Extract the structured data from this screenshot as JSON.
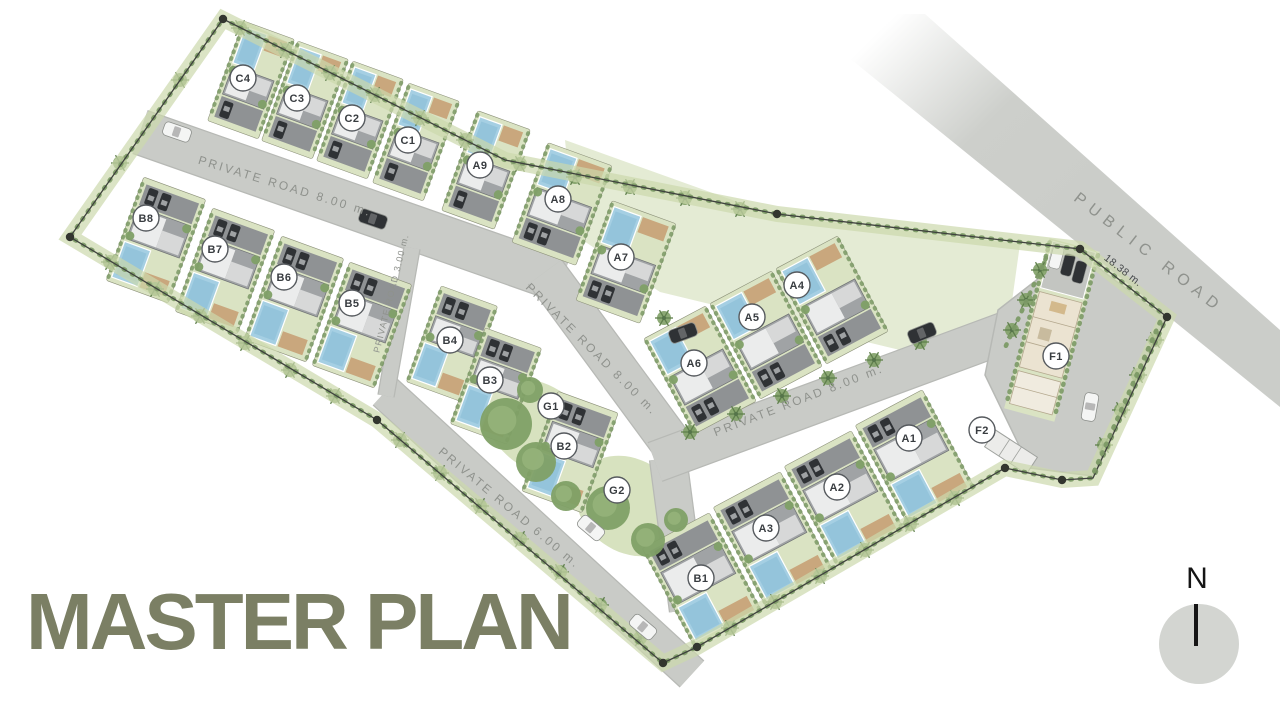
{
  "title": {
    "text": "MASTER PLAN",
    "color": "#7b7f64"
  },
  "compass": {
    "letter": "N",
    "cx": 1199,
    "cy": 644,
    "r": 40
  },
  "palette": {
    "road": "#c9cbc7",
    "road_edge": "#b7b9b5",
    "public_road": "#cdcfcb",
    "lawn": "#dae3c3",
    "lawn_light": "#e4ebd4",
    "hedge": "#7c9a66",
    "hedge_soft": "#ccd9ac",
    "tree": "#7fa066",
    "tree_inner": "#95b27a",
    "pool": "#a5cfe3",
    "pool_dark": "#86bcd6",
    "deck": "#c9a77d",
    "house": "#a0a3a5",
    "roof_white": "#ebecec",
    "roof_gray": "#d7d8d8",
    "driveway": "#8f9294",
    "car_dark": "#2f3235",
    "car_white": "#f4f5f4",
    "boundary": "#3f423e",
    "node": "#33362f",
    "marker_stroke": "#565a5e",
    "marker_text": "#383c40",
    "road_label": "#8f928d",
    "road_label_dark": "#46494b"
  },
  "map": {
    "boundary": {
      "points": [
        [
          223,
          19
        ],
        [
          505,
          160
        ],
        [
          777,
          214
        ],
        [
          1080,
          249
        ],
        [
          1167,
          317
        ],
        [
          1093,
          478
        ],
        [
          1062,
          480
        ],
        [
          1005,
          468
        ],
        [
          697,
          647
        ],
        [
          663,
          663
        ],
        [
          377,
          420
        ],
        [
          70,
          237
        ]
      ],
      "nodes": [
        [
          223,
          19
        ],
        [
          777,
          214
        ],
        [
          1080,
          249
        ],
        [
          1167,
          317
        ],
        [
          1062,
          480
        ],
        [
          1005,
          468
        ],
        [
          697,
          647
        ],
        [
          663,
          663
        ],
        [
          377,
          420
        ],
        [
          70,
          237
        ]
      ]
    },
    "roads": [
      {
        "name": "private-road-8m-north",
        "path": "M140,132 L562,280",
        "width": 44
      },
      {
        "name": "private-road-8m-mid",
        "path": "M545,272 L676,450",
        "width": 40
      },
      {
        "name": "junction-connector",
        "path": "M668,458 L688,610",
        "width": 36
      },
      {
        "name": "private-road-8m-south",
        "path": "M655,462 L1012,330",
        "width": 40
      },
      {
        "name": "private-road-6m",
        "path": "M385,392 L692,674",
        "width": 34
      },
      {
        "name": "private-road-3m",
        "path": "M412,248 L386,396",
        "width": 15
      }
    ],
    "plaza": [
      [
        998,
        310
      ],
      [
        1075,
        250
      ],
      [
        1165,
        318
      ],
      [
        1093,
        476
      ],
      [
        1030,
        468
      ],
      [
        985,
        375
      ]
    ],
    "public_road": {
      "points": [
        [
          795,
          14
        ],
        [
          925,
          14
        ],
        [
          1280,
          330
        ],
        [
          1280,
          407
        ]
      ],
      "fade_from": [
        880,
        30
      ],
      "fade_to": [
        1060,
        215
      ]
    },
    "lawns": [
      {
        "type": "poly",
        "points": [
          [
            565,
            140
          ],
          [
            777,
            216
          ],
          [
            1020,
            244
          ],
          [
            1008,
            330
          ],
          [
            900,
            350
          ],
          [
            660,
            292
          ],
          [
            575,
            235
          ]
        ]
      },
      {
        "type": "ellipse",
        "cx": 540,
        "cy": 428,
        "rx": 62,
        "ry": 42,
        "rot": 35
      },
      {
        "type": "ellipse",
        "cx": 630,
        "cy": 506,
        "rx": 58,
        "ry": 46,
        "rot": 35
      }
    ],
    "entrance_hedges": [
      [
        [
          1046,
          258
        ],
        [
          1004,
          350
        ]
      ],
      [
        [
          1160,
          322
        ],
        [
          1093,
          474
        ]
      ]
    ],
    "villas": [
      {
        "id": "C4",
        "x": 251,
        "y": 80,
        "w": 54,
        "h": 106,
        "rot": 20,
        "flip": false
      },
      {
        "id": "C3",
        "x": 305,
        "y": 100,
        "w": 54,
        "h": 106,
        "rot": 20,
        "flip": false
      },
      {
        "id": "C2",
        "x": 360,
        "y": 120,
        "w": 54,
        "h": 106,
        "rot": 20,
        "flip": false
      },
      {
        "id": "C1",
        "x": 416,
        "y": 142,
        "w": 54,
        "h": 106,
        "rot": 20,
        "flip": false
      },
      {
        "id": "A9",
        "x": 486,
        "y": 170,
        "w": 56,
        "h": 106,
        "rot": 20,
        "flip": false
      },
      {
        "id": "A8",
        "x": 562,
        "y": 204,
        "w": 68,
        "h": 106,
        "rot": 20,
        "flip": false
      },
      {
        "id": "A7",
        "x": 626,
        "y": 262,
        "w": 68,
        "h": 106,
        "rot": 20,
        "flip": false
      },
      {
        "id": "B8",
        "x": 156,
        "y": 240,
        "w": 66,
        "h": 110,
        "rot": 20,
        "flip": true
      },
      {
        "id": "B7",
        "x": 225,
        "y": 271,
        "w": 66,
        "h": 110,
        "rot": 20,
        "flip": true
      },
      {
        "id": "B6",
        "x": 294,
        "y": 299,
        "w": 66,
        "h": 110,
        "rot": 20,
        "flip": true
      },
      {
        "id": "B5",
        "x": 362,
        "y": 325,
        "w": 66,
        "h": 110,
        "rot": 20,
        "flip": true
      },
      {
        "id": "B4",
        "x": 452,
        "y": 344,
        "w": 60,
        "h": 102,
        "rot": 20,
        "flip": true
      },
      {
        "id": "B3",
        "x": 496,
        "y": 386,
        "w": 60,
        "h": 102,
        "rot": 20,
        "flip": true
      },
      {
        "id": "B2",
        "x": 570,
        "y": 452,
        "w": 64,
        "h": 106,
        "rot": 20,
        "flip": true
      },
      {
        "id": "A6",
        "x": 700,
        "y": 370,
        "w": 70,
        "h": 108,
        "rot": -28,
        "flip": false
      },
      {
        "id": "A5",
        "x": 766,
        "y": 335,
        "w": 70,
        "h": 108,
        "rot": -28,
        "flip": false
      },
      {
        "id": "A4",
        "x": 832,
        "y": 300,
        "w": 70,
        "h": 108,
        "rot": -28,
        "flip": false
      },
      {
        "id": "B1",
        "x": 702,
        "y": 580,
        "w": 76,
        "h": 112,
        "rot": -28,
        "flip": true
      },
      {
        "id": "A3",
        "x": 773,
        "y": 539,
        "w": 76,
        "h": 112,
        "rot": -28,
        "flip": true
      },
      {
        "id": "A2",
        "x": 844,
        "y": 498,
        "w": 76,
        "h": 112,
        "rot": -28,
        "flip": true
      },
      {
        "id": "A1",
        "x": 915,
        "y": 457,
        "w": 76,
        "h": 112,
        "rot": -28,
        "flip": true
      }
    ],
    "facilities": {
      "f1": {
        "x": 1052,
        "y": 330,
        "rot": 15
      },
      "f2": {
        "x": 1011,
        "y": 452,
        "rot": 33
      }
    },
    "plot_markers": [
      {
        "id": "C4",
        "label": "C4",
        "x": 243,
        "y": 78
      },
      {
        "id": "C3",
        "label": "C3",
        "x": 297,
        "y": 98
      },
      {
        "id": "C2",
        "label": "C2",
        "x": 352,
        "y": 118
      },
      {
        "id": "C1",
        "label": "C1",
        "x": 408,
        "y": 140
      },
      {
        "id": "A9",
        "label": "A9",
        "x": 480,
        "y": 165
      },
      {
        "id": "A8",
        "label": "A8",
        "x": 558,
        "y": 199
      },
      {
        "id": "A7",
        "label": "A7",
        "x": 621,
        "y": 257
      },
      {
        "id": "B8",
        "label": "B8",
        "x": 146,
        "y": 218
      },
      {
        "id": "B7",
        "label": "B7",
        "x": 215,
        "y": 249
      },
      {
        "id": "B6",
        "label": "B6",
        "x": 284,
        "y": 277
      },
      {
        "id": "B5",
        "label": "B5",
        "x": 352,
        "y": 303
      },
      {
        "id": "B4",
        "label": "B4",
        "x": 450,
        "y": 340
      },
      {
        "id": "B3",
        "label": "B3",
        "x": 490,
        "y": 380
      },
      {
        "id": "G1",
        "label": "G1",
        "x": 551,
        "y": 406
      },
      {
        "id": "B2",
        "label": "B2",
        "x": 564,
        "y": 446
      },
      {
        "id": "G2",
        "label": "G2",
        "x": 617,
        "y": 490
      },
      {
        "id": "A4",
        "label": "A4",
        "x": 797,
        "y": 285
      },
      {
        "id": "A5",
        "label": "A5",
        "x": 752,
        "y": 317
      },
      {
        "id": "A6",
        "label": "A6",
        "x": 694,
        "y": 363
      },
      {
        "id": "A1",
        "label": "A1",
        "x": 909,
        "y": 438
      },
      {
        "id": "A2",
        "label": "A2",
        "x": 837,
        "y": 487
      },
      {
        "id": "A3",
        "label": "A3",
        "x": 766,
        "y": 528
      },
      {
        "id": "B1",
        "label": "B1",
        "x": 701,
        "y": 578
      },
      {
        "id": "F1",
        "label": "F1",
        "x": 1056,
        "y": 356
      },
      {
        "id": "F2",
        "label": "F2",
        "x": 982,
        "y": 430
      }
    ],
    "road_labels": [
      {
        "text": "PRIVATE ROAD 8.00 m.",
        "x": 284,
        "y": 190,
        "rot": 17,
        "size": 12,
        "ls": 2.5,
        "dark": false
      },
      {
        "text": "PRIVATE ROAD 8.00 m.",
        "x": 589,
        "y": 352,
        "rot": 45,
        "size": 12,
        "ls": 2.5,
        "dark": false
      },
      {
        "text": "PRIVATE ROAD 8.00 m.",
        "x": 800,
        "y": 404,
        "rot": -21,
        "size": 12,
        "ls": 2.5,
        "dark": false
      },
      {
        "text": "PRIVATE ROAD 3.00 m.",
        "x": 394,
        "y": 294,
        "rot": -76,
        "size": 9,
        "ls": 1.2,
        "dark": false
      },
      {
        "text": "PRIVATE ROAD 6.00 m.",
        "x": 507,
        "y": 511,
        "rot": 40,
        "size": 12,
        "ls": 2.5,
        "dark": false
      },
      {
        "text": "PUBLIC ROAD",
        "x": 1146,
        "y": 257,
        "rot": 38,
        "size": 16,
        "ls": 7,
        "dark": false
      },
      {
        "text": "18.38 m.",
        "x": 1121,
        "y": 273,
        "rot": 38,
        "size": 10.5,
        "ls": 0.5,
        "dark": true
      }
    ],
    "trees": [
      [
        506,
        424,
        26
      ],
      [
        536,
        462,
        20
      ],
      [
        566,
        496,
        15
      ],
      [
        608,
        508,
        22
      ],
      [
        648,
        540,
        17
      ],
      [
        676,
        520,
        12
      ],
      [
        530,
        390,
        13
      ]
    ],
    "palms": [
      [
        240,
        28
      ],
      [
        285,
        50
      ],
      [
        330,
        73
      ],
      [
        375,
        95
      ],
      [
        420,
        118
      ],
      [
        465,
        140
      ],
      [
        520,
        164
      ],
      [
        575,
        177
      ],
      [
        630,
        187
      ],
      [
        685,
        198
      ],
      [
        740,
        209
      ],
      [
        180,
        80
      ],
      [
        120,
        163
      ],
      [
        110,
        262
      ],
      [
        155,
        289
      ],
      [
        200,
        316
      ],
      [
        245,
        343
      ],
      [
        290,
        370
      ],
      [
        335,
        396
      ],
      [
        400,
        440
      ],
      [
        440,
        473
      ],
      [
        480,
        506
      ],
      [
        520,
        539
      ],
      [
        560,
        572
      ],
      [
        600,
        605
      ],
      [
        640,
        638
      ],
      [
        730,
        628
      ],
      [
        775,
        602
      ],
      [
        820,
        576
      ],
      [
        865,
        550
      ],
      [
        910,
        524
      ],
      [
        955,
        498
      ],
      [
        1155,
        340
      ],
      [
        1138,
        375
      ],
      [
        1121,
        410
      ],
      [
        1104,
        445
      ],
      [
        1040,
        270
      ],
      [
        1026,
        300
      ],
      [
        1012,
        330
      ],
      [
        690,
        432
      ],
      [
        736,
        414
      ],
      [
        782,
        396
      ],
      [
        828,
        378
      ],
      [
        874,
        360
      ],
      [
        920,
        342
      ],
      [
        664,
        318
      ]
    ],
    "cars": [
      {
        "x": 177,
        "y": 132,
        "rot": 19,
        "color": "white"
      },
      {
        "x": 373,
        "y": 219,
        "rot": 19,
        "color": "dark"
      },
      {
        "x": 683,
        "y": 333,
        "rot": -20,
        "color": "dark"
      },
      {
        "x": 922,
        "y": 333,
        "rot": -22,
        "color": "dark"
      },
      {
        "x": 591,
        "y": 528,
        "rot": 40,
        "color": "white"
      },
      {
        "x": 643,
        "y": 627,
        "rot": 40,
        "color": "white"
      },
      {
        "x": 1090,
        "y": 407,
        "rot": 100,
        "color": "white"
      }
    ]
  }
}
